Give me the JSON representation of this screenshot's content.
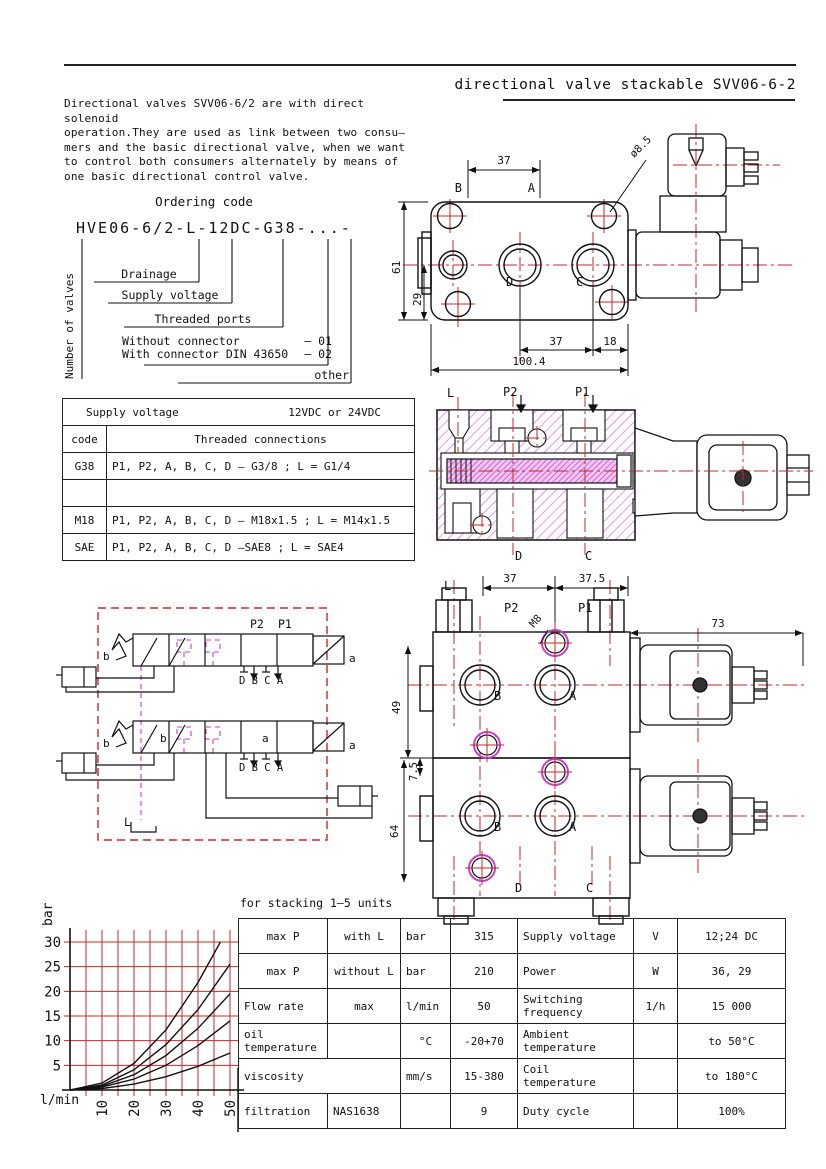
{
  "header": {
    "title": "directional valve stackable SVV06-6-2"
  },
  "intro": {
    "text": "Directional valves SVV06-6/2 are with direct solenoid\noperation.They are used as link between two consu–\nmers and the basic directional valve, when we want\nto control both consumers alternately by means of\none basic directional control valve."
  },
  "ordering": {
    "title": "Ordering code",
    "code": "HVE06-6/2-L-12DC-G38-...-",
    "number_of_valves": "Number of valves",
    "drainage": "Drainage",
    "supply_voltage": "Supply voltage",
    "threaded_ports": "Threaded ports",
    "without_connector": "Without connector",
    "without_code": "– 01",
    "with_connector": "With connector DIN 43650",
    "with_code": "– 02",
    "other": "other"
  },
  "supply_table": {
    "supply_label": "Supply voltage",
    "supply_value": "12VDC or 24VDC",
    "code_header": "code",
    "connections_header": "Threaded connections",
    "rows": [
      {
        "code": "G38",
        "connections": "P1, P2, A, B, C, D – G3/8 ; L = G1/4"
      },
      {
        "code": "",
        "connections": ""
      },
      {
        "code": "M18",
        "connections": "P1, P2, A, B, C, D – M18x1.5 ; L = M14x1.5"
      },
      {
        "code": "SAE",
        "connections": "P1, P2, A, B, C, D –SAE8 ; L = SAE4"
      }
    ]
  },
  "drawing_top": {
    "dim_37_top": "37",
    "dim_hole": "ø8.5",
    "dim_61": "61",
    "dim_29": "29",
    "dim_37_bottom": "37",
    "dim_18": "18",
    "dim_total": "100.4",
    "port_b": "B",
    "port_a": "A",
    "port_d": "D",
    "port_c": "C"
  },
  "cross_section": {
    "label_l": "L",
    "label_p2": "P2",
    "label_p1": "P1",
    "label_d": "D",
    "label_c": "C"
  },
  "schematic": {
    "label_p2": "P2",
    "label_p1": "P1",
    "label_b": "b",
    "label_a": "a",
    "ports": "D B C A",
    "label_l": "L"
  },
  "drawing_stacked": {
    "dim_37": "37",
    "dim_37_5": "37.5",
    "dim_73": "73",
    "dim_49": "49",
    "dim_7_5": "7.5",
    "dim_64": "64",
    "thread": "M8",
    "label_l": "L",
    "label_p2": "P2",
    "label_p1": "P1",
    "port_b": "B",
    "port_a": "A",
    "port_d": "D",
    "port_c": "C"
  },
  "chart_data": {
    "type": "line",
    "xlabel": "l/min",
    "ylabel": "bar",
    "x_ticks": [
      10,
      20,
      30,
      40,
      50
    ],
    "y_ticks": [
      5,
      10,
      15,
      20,
      25,
      30
    ],
    "xlim": [
      0,
      52
    ],
    "ylim": [
      0,
      32
    ],
    "grid": true,
    "grid_color": "#c62828",
    "curve_color": "#111111",
    "series": [
      {
        "name": "curve-1",
        "points": [
          [
            0,
            0
          ],
          [
            10,
            1.4
          ],
          [
            20,
            5.4
          ],
          [
            30,
            12.2
          ],
          [
            40,
            21.8
          ],
          [
            47,
            30
          ]
        ]
      },
      {
        "name": "curve-2",
        "points": [
          [
            0,
            0
          ],
          [
            10,
            1.0
          ],
          [
            20,
            4.1
          ],
          [
            30,
            9.2
          ],
          [
            40,
            16.3
          ],
          [
            50,
            25.5
          ]
        ]
      },
      {
        "name": "curve-3",
        "points": [
          [
            0,
            0
          ],
          [
            10,
            0.8
          ],
          [
            20,
            3.1
          ],
          [
            30,
            7.0
          ],
          [
            40,
            12.5
          ],
          [
            50,
            19.5
          ]
        ]
      },
      {
        "name": "curve-4",
        "points": [
          [
            0,
            0
          ],
          [
            10,
            0.6
          ],
          [
            20,
            2.2
          ],
          [
            30,
            5.0
          ],
          [
            40,
            9.0
          ],
          [
            50,
            14.0
          ]
        ]
      },
      {
        "name": "curve-5",
        "points": [
          [
            0,
            0
          ],
          [
            10,
            0.3
          ],
          [
            20,
            1.2
          ],
          [
            30,
            2.7
          ],
          [
            40,
            4.8
          ],
          [
            50,
            7.5
          ]
        ]
      }
    ]
  },
  "spec_table": {
    "caption": "for stacking 1–5 units",
    "rows": [
      {
        "c0": "max P",
        "c1": "with L",
        "c2": "bar",
        "c3": "315",
        "c4": "Supply voltage",
        "c5": "V",
        "c6": "12;24 DC"
      },
      {
        "c0": "max P",
        "c1": "without L",
        "c2": "bar",
        "c3": "210",
        "c4": "Power",
        "c5": "W",
        "c6": "36, 29"
      },
      {
        "c0": "Flow rate",
        "c1": "max",
        "c2": "l/min",
        "c3": "50",
        "c4": "Switching\nfrequency",
        "c5": "1/h",
        "c6": "15 000"
      },
      {
        "c0": "oil\ntemperature",
        "c1": "",
        "c2": "°C",
        "c3": "-20+70",
        "c4": "Ambient\ntemperature",
        "c5": "",
        "c6": "to 50°C"
      },
      {
        "c0": "viscosity",
        "c1": "",
        "c2": "mm/s",
        "c3": "15-380",
        "c4": "Coil temperature",
        "c5": "",
        "c6": "to 180°C"
      },
      {
        "c0": "filtration",
        "c1": "NAS1638",
        "c2": "",
        "c3": "9",
        "c4": "Duty cycle",
        "c5": "",
        "c6": "100%"
      }
    ]
  }
}
